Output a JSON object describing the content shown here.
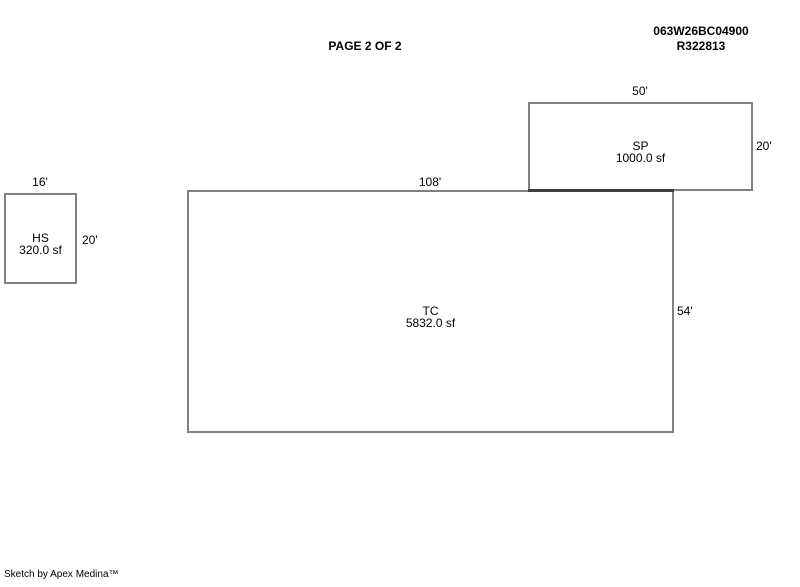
{
  "header": {
    "page_title": "PAGE 2 OF 2",
    "parcel_id": "063W26BC04900",
    "record_id": "R322813"
  },
  "sketch": {
    "areas": [
      {
        "code": "HS",
        "area": "320.0 sf",
        "width_label": "16'",
        "height_label": "20'"
      },
      {
        "code": "SP",
        "area": "1000.0 sf",
        "width_label": "50'",
        "height_label": "20'"
      },
      {
        "code": "TC",
        "area": "5832.0 sf",
        "width_label": "108'",
        "height_label": "54'"
      }
    ]
  },
  "footer": {
    "credit": "Sketch by Apex Medina™"
  },
  "colors": {
    "outline": "#808080",
    "outline_overlap": "#3d3d3d",
    "text": "#000000",
    "background": "#ffffff"
  }
}
